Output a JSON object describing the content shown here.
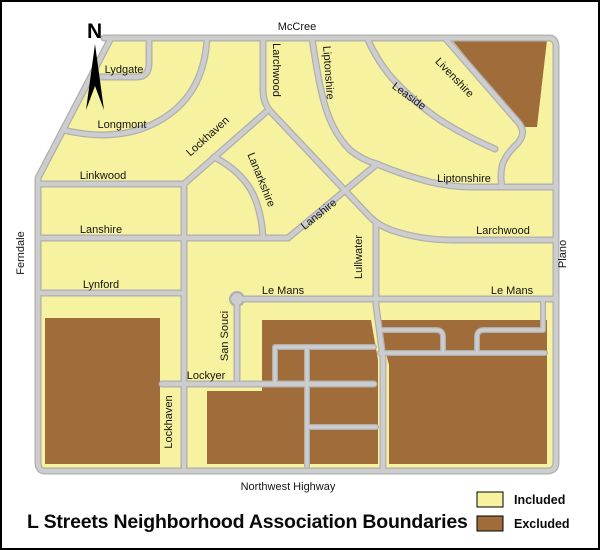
{
  "title": "L Streets Neighborhood Association Boundaries",
  "north_indicator": "N",
  "legend": {
    "included_label": "Included",
    "excluded_label": "Excluded"
  },
  "colors": {
    "included": "#F6F2A0",
    "excluded": "#A06C3A",
    "road_fill": "#CDCDCD",
    "road_casing": "#AFAFAF"
  },
  "street_labels": {
    "mccree": "McCree",
    "plano": "Plano",
    "ferndale": "Ferndale",
    "northwest_highway": "Northwest Highway",
    "lydgate": "Lydgate",
    "longmont": "Longmont",
    "linkwood": "Linkwood",
    "lanshire_w": "Lanshire",
    "lanshire_diag": "Lanshire",
    "lynford": "Lynford",
    "le_mans_w": "Le Mans",
    "le_mans_e": "Le Mans",
    "larchwood_n": "Larchwood",
    "larchwood_e": "Larchwood",
    "liptonshire_nw": "Liptonshire",
    "liptonshire_e": "Liptonshire",
    "leaside": "Leaside",
    "livenshire": "Livenshire",
    "lockhaven_n": "Lockhaven",
    "lockhaven_s": "Lockhaven",
    "lanarkshire": "Lanarkshire",
    "lullwater": "Lullwater",
    "san_souci": "San Souci",
    "lockyer": "Lockyer"
  }
}
